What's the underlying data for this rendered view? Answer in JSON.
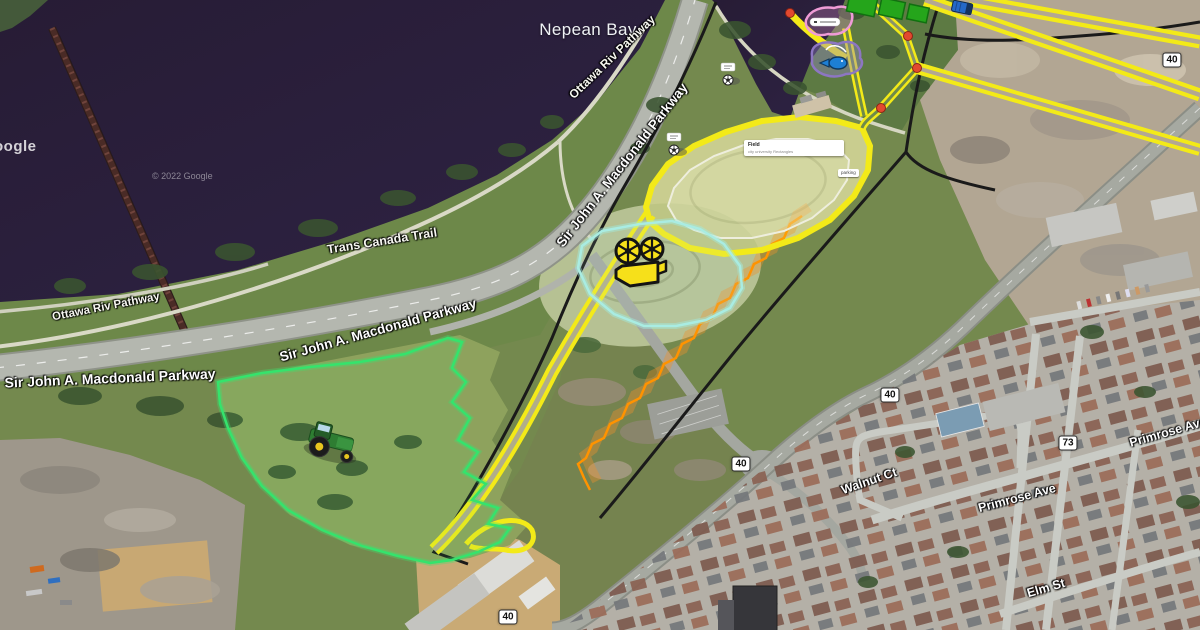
{
  "labels": {
    "nepean_bay": "Nepean Bay",
    "pathway_diagonal": "Ottawa Riv Pathway",
    "pathway_shore": "Ottawa Riv Pathway",
    "trans_canada_trail": "Trans Canada Trail",
    "parkway_west": "Sir John A. Macdonald Parkway",
    "parkway_mid": "Sir John A. Macdonald Parkway",
    "parkway_diagonal": "Sir John A. Macdonald Parkway",
    "walnut_ct": "Walnut Ct",
    "primrose_ave": "Primrose Ave",
    "primrose_ave_east": "Primrose Ave",
    "elm_st": "Elm St"
  },
  "route_badges": {
    "b40_top": "40",
    "b40_mid": "40",
    "b40_intersection": "40",
    "b40_bottom": "40",
    "b73": "73"
  },
  "annotations": {
    "field_card_title": "Field",
    "field_card_subtitle": "city university Rectangles",
    "parking_tag": "parking"
  },
  "watermarks": {
    "google_logo_partial": "oogle",
    "copyright": "© 2022 Google"
  },
  "icons": {
    "film_camera": "film-camera-icon",
    "tractor": "tractor-icon",
    "soccer_north": "soccer-ball-icon",
    "soccer_south": "soccer-ball-icon",
    "fishing_pond": "fish-icon",
    "garden_plots": "garden-plots-icon",
    "truck": "truck-icon",
    "junction_dots": "junction-dot-icon"
  },
  "colors": {
    "overlay_yellow": "#f3ea18",
    "overlay_green": "#35e36c",
    "overlay_cyan": "#a9ece2",
    "overlay_orange": "#ff9300",
    "overlay_pink": "#ef9bd6",
    "overlay_purple": "#8d76c2",
    "boundary_black": "#1a1a1a",
    "junction_dot": "#e2492f",
    "water": "#291e39"
  }
}
